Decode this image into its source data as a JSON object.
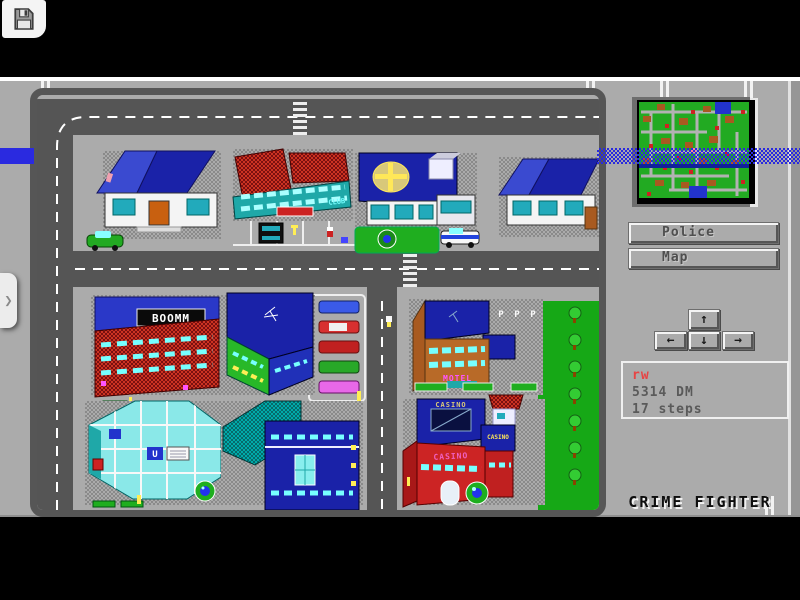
{
  "emulator": {
    "save_icon": "floppy-disk",
    "drawer_chevron": "❯"
  },
  "panel": {
    "buttons": [
      {
        "label": "Police"
      },
      {
        "label": "Map"
      }
    ],
    "dpad": {
      "up": "↑",
      "left": "←",
      "down": "↓",
      "right": "→"
    },
    "status": {
      "player_initials": "rw",
      "money": "5314 DM",
      "steps": "17 steps"
    },
    "game_title": "CRIME FIGHTER"
  },
  "city": {
    "building_signs": {
      "boomm": "BOOMM",
      "club": "CLUB",
      "motel": "MOTEL",
      "casino_roof": "CASINO",
      "casino_side": "CASINO",
      "casino_wall": "CASINO",
      "parking_p": "P",
      "u_sign": "U"
    }
  },
  "colors": {
    "band_blue": "#2a2ae0",
    "road_gray": "#555555",
    "screen_gray": "#ababab",
    "minimap_green": "#22aa22",
    "status_red": "#e84444"
  }
}
